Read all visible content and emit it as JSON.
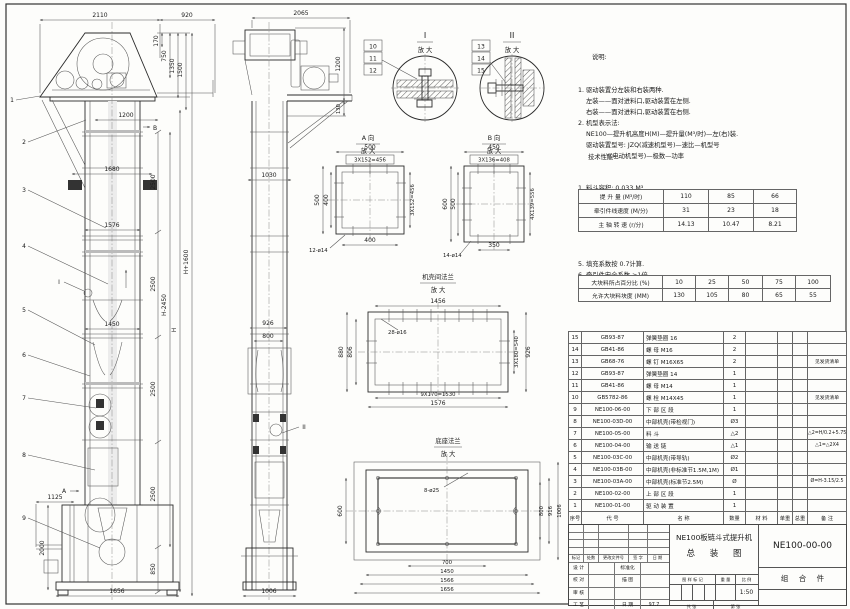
{
  "front_view": {
    "dims": {
      "top_left": "2110",
      "top_right": "920",
      "head_a": "170",
      "head_b": "750",
      "head_c": "1350",
      "head_d": "1500",
      "platform": "1200",
      "bracket": "1680",
      "flange": "1576",
      "middle": "1450",
      "sec1": "2500",
      "sec2": "2500",
      "sec3": "2500",
      "sec4": "2500",
      "boot_inlet": "1125",
      "boot_height": "2000",
      "boot_lower": "850",
      "base_width": "1656",
      "h_minus": "H-2450",
      "h": "H",
      "h_plus": "H+1600"
    },
    "leaders": [
      "1",
      "2",
      "3",
      "4",
      "5",
      "6",
      "7",
      "8",
      "9"
    ],
    "view_a_marker": "A",
    "view_b_marker": "B",
    "detail_i_marker": "I"
  },
  "side_view": {
    "dims": {
      "top": "2065",
      "head_height": "1200",
      "head_gap": "130",
      "column": "1030",
      "upper": "926",
      "inner": "800",
      "base": "1006"
    },
    "detail_ii_marker": "II"
  },
  "detail_i": {
    "title": "I",
    "subtitle": "放 大",
    "items": [
      "10",
      "11",
      "12"
    ]
  },
  "detail_ii": {
    "title": "II",
    "subtitle": "放 大",
    "items": [
      "13",
      "14",
      "15"
    ]
  },
  "view_a": {
    "title": "A 向",
    "subtitle": "放 大",
    "dims": {
      "top": "500",
      "top_pitch": "3X152=456",
      "left": "500",
      "left_inner": "400",
      "right_pitch": "3X152=456",
      "bottom": "400",
      "holes": "12-ø14"
    }
  },
  "view_b": {
    "title": "B 向",
    "subtitle": "放 大",
    "dims": {
      "top": "450",
      "top_pitch": "3X136=408",
      "left": "600",
      "left_inner": "500",
      "right_pitch": "4X139=556",
      "bottom": "350",
      "holes": "14-ø14"
    }
  },
  "flange_detail": {
    "title": "机壳间法兰",
    "subtitle": "放 大",
    "dims": {
      "top": "1456",
      "holes": "28-ø16",
      "left_outer": "880",
      "left_inner": "806",
      "right_pitch": "3X180=540",
      "right_outer": "926",
      "bottom_pitch": "9X170=1530",
      "bottom": "1576"
    }
  },
  "base_detail": {
    "title": "底座法兰",
    "subtitle": "放 大",
    "dims": {
      "holes": "8-ø25",
      "left": "600",
      "right_1": "800",
      "right_2": "916",
      "right_3": "1006",
      "bottom_1": "700",
      "bottom_2": "1450",
      "bottom_3": "1566",
      "bottom_4": "1656"
    }
  },
  "notes": {
    "title": "说明:",
    "lines": [
      "1. 驱动装置分左装和右装两种.",
      "    左装——面对进料口,驱动装置在左侧.",
      "    右装——面对进料口,驱动装置在右侧.",
      "2. 机型表示法:",
      "    NE100—提升机高度H(M)—提升量(M³/时)—左(右)装.",
      "    驱动装置型号: JZQ(减速机型号)—速比—机型号",
      "              Y(电动机型号)—极数—功率"
    ]
  },
  "specs": {
    "title": "技术性能:",
    "lines_before": [
      "1. 料斗容积: 0.033 M³.",
      "2. 斗    距: 0.4 M.",
      "3. 斗    宽: 0.4 M.",
      "5. 提升量,牵引件线速度和主轴转速:"
    ],
    "table1": [
      {
        "label": "提 升 量 (M³/时)",
        "v1": "110",
        "v2": "85",
        "v3": "66"
      },
      {
        "label": "牵引件线速度 (M/分)",
        "v1": "31",
        "v2": "23",
        "v3": "18"
      },
      {
        "label": "主 轴 转 速 (r/分)",
        "v1": "14.13",
        "v2": "10.47",
        "v3": "8.21"
      }
    ],
    "lines_mid": [
      "5. 填充系数按 0.7计算.",
      "6. 牵引件安全系数 >1倍.",
      "7. 输料块度:"
    ],
    "table2": [
      {
        "label": "大块料所占百分比 (%)",
        "v1": "10",
        "v2": "25",
        "v3": "50",
        "v4": "75",
        "v5": "100"
      },
      {
        "label": "允许大块料块度 (MM)",
        "v1": "130",
        "v2": "105",
        "v3": "80",
        "v4": "65",
        "v5": "55"
      }
    ]
  },
  "bom": {
    "header": {
      "no": "序号",
      "code": "代  号",
      "name": "名   称",
      "qty": "数量",
      "mat": "材  料",
      "uw": "单重",
      "tw": "总重",
      "rem": "备  注"
    },
    "rows": [
      {
        "no": "15",
        "code": "GB93-87",
        "name": "弹簧垫圈  16",
        "qty": "2",
        "mat": "",
        "uw": "",
        "tw": "",
        "rem": ""
      },
      {
        "no": "14",
        "code": "GB41-86",
        "name": "螺  母  M16",
        "qty": "2",
        "mat": "",
        "uw": "",
        "tw": "",
        "rem": ""
      },
      {
        "no": "13",
        "code": "GB68-76",
        "name": "螺  钉  M16X65",
        "qty": "2",
        "mat": "",
        "uw": "",
        "tw": "",
        "rem": "见发货清单"
      },
      {
        "no": "12",
        "code": "GB93-87",
        "name": "弹簧垫圈  14",
        "qty": "1",
        "mat": "",
        "uw": "",
        "tw": "",
        "rem": ""
      },
      {
        "no": "11",
        "code": "GB41-86",
        "name": "螺  母  M14",
        "qty": "1",
        "mat": "",
        "uw": "",
        "tw": "",
        "rem": ""
      },
      {
        "no": "10",
        "code": "GB5782-86",
        "name": "螺  栓  M14X45",
        "qty": "1",
        "mat": "",
        "uw": "",
        "tw": "",
        "rem": "见发货清单"
      },
      {
        "no": "9",
        "code": "NE100-06-00",
        "name": "下 部 区 段",
        "qty": "1",
        "mat": "",
        "uw": "",
        "tw": "",
        "rem": ""
      },
      {
        "no": "8",
        "code": "NE100-03D-00",
        "name": "中部机壳(带检视门)",
        "qty": "Ø3",
        "mat": "",
        "uw": "",
        "tw": "",
        "rem": ""
      },
      {
        "no": "7",
        "code": "NE100-05-00",
        "name": "料  斗",
        "qty": "△2",
        "mat": "",
        "uw": "",
        "tw": "",
        "rem": "△2=H/0.2+5.75"
      },
      {
        "no": "6",
        "code": "NE100-04-00",
        "name": "输 送 链",
        "qty": "△1",
        "mat": "",
        "uw": "",
        "tw": "",
        "rem": "△1=△2X4"
      },
      {
        "no": "5",
        "code": "NE100-03C-00",
        "name": "中部机壳(带导轨)",
        "qty": "Ø2",
        "mat": "",
        "uw": "",
        "tw": "",
        "rem": ""
      },
      {
        "no": "4",
        "code": "NE100-03B-00",
        "name": "中部机壳(非标准节1.5M,1M)",
        "qty": "Ø1",
        "mat": "",
        "uw": "",
        "tw": "",
        "rem": ""
      },
      {
        "no": "3",
        "code": "NE100-03A-00",
        "name": "中部机壳(标准节2.5M)",
        "qty": "Ø",
        "mat": "",
        "uw": "",
        "tw": "",
        "rem": "Ø=H-3.15/2.5"
      },
      {
        "no": "2",
        "code": "NE100-02-00",
        "name": "上 部 区 段",
        "qty": "1",
        "mat": "",
        "uw": "",
        "tw": "",
        "rem": ""
      },
      {
        "no": "1",
        "code": "NE100-01-00",
        "name": "驱 动 装 置",
        "qty": "1",
        "mat": "",
        "uw": "",
        "tw": "",
        "rem": ""
      }
    ]
  },
  "title_block": {
    "product": "NE100板链斗式提升机",
    "drawing_title": "总 装 图",
    "drawing_no": "NE100-00-00",
    "part_type": "组 合 件",
    "scale": "1:50",
    "labels": {
      "mark": "标记",
      "count": "处数",
      "doc_no": "更改文件号",
      "sign": "签 字",
      "date": "日 期",
      "stamp": "图 样 标 记",
      "weight": "重 量",
      "scale_l": "比 例",
      "sheets": "共   张",
      "sheet_no": "第   张"
    },
    "sign_rows": [
      {
        "left": "设 计",
        "mid": "标准化",
        "val": ""
      },
      {
        "left": "校 对",
        "mid": "描 图",
        "val": ""
      },
      {
        "left": "审 核",
        "mid": "",
        "val": ""
      },
      {
        "left": "工 艺",
        "mid": "日 期",
        "val": "97.7"
      }
    ]
  }
}
